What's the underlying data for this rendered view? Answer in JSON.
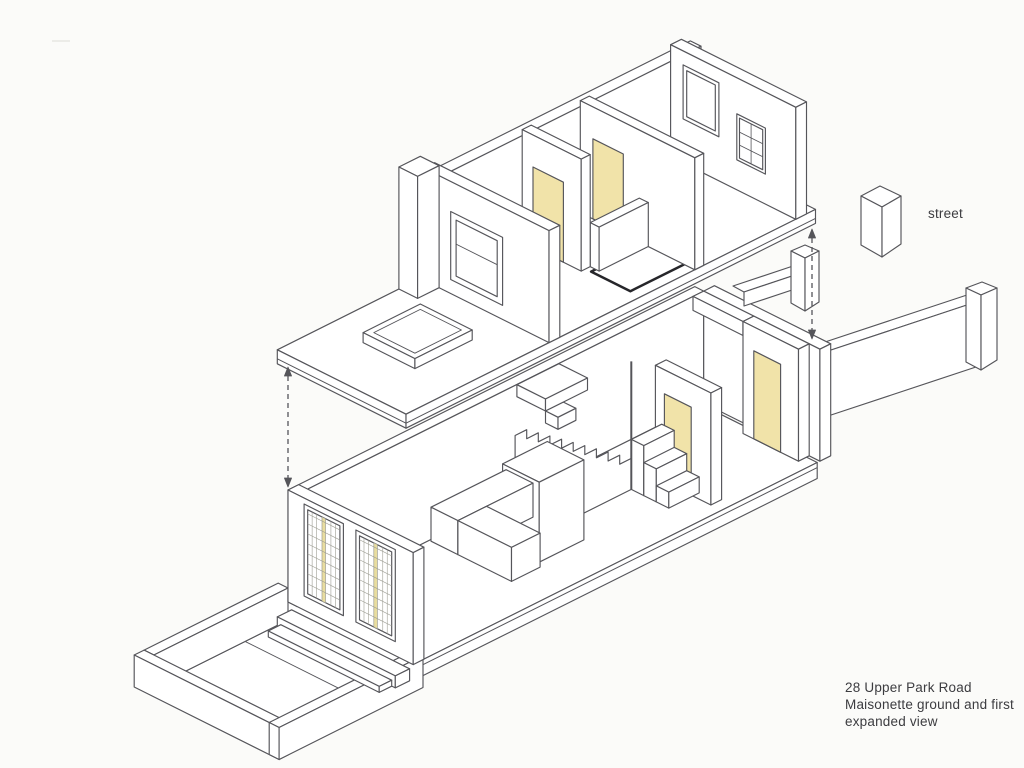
{
  "drawing": {
    "street_label": "street",
    "caption_lines": [
      "28 Upper Park Road",
      "Maisonette ground and first",
      "expanded view"
    ],
    "colors": {
      "background": "#fbfbf9",
      "line": "#55555a",
      "heavy_line": "#26262a",
      "door_yellow": "#f1e3a9",
      "glazing_yellow": "#e9dd9f",
      "grid_line": "#9e9e94",
      "text": "#3c3c40"
    }
  }
}
